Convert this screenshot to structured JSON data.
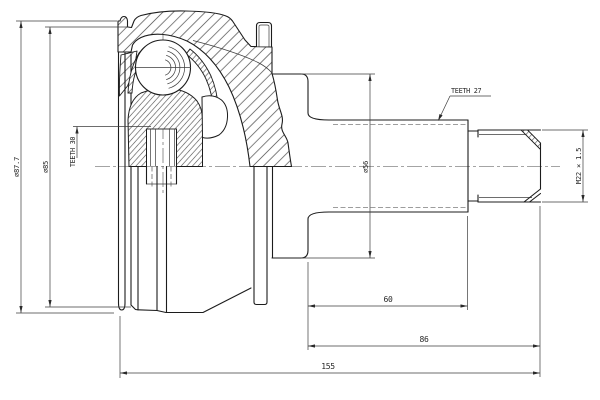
{
  "drawing": {
    "labels": {
      "dia_outer": "⌀87.7",
      "dia_groove": "⌀85",
      "teeth_inner_spline": "TEETH 30",
      "teeth_outer_spline": "TEETH 27",
      "dia_shoulder": "⌀56",
      "thread_spec": "M22 × 1.5",
      "dim_spline_len": "60",
      "dim_shaft_len": "86",
      "dim_overall_len": "155"
    },
    "colors": {
      "line": "#1c1c1c",
      "thin_line": "#3d3d3d",
      "background": "#ffffff"
    }
  }
}
